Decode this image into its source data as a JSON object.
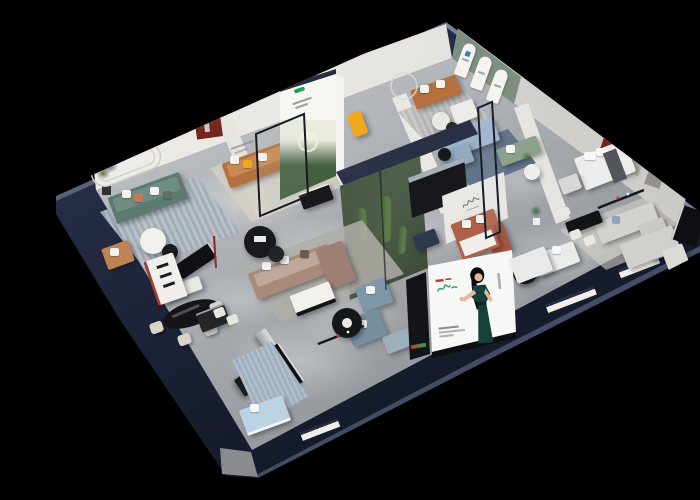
{
  "meta": {
    "title": "Isometric 3D cutaway render of a furniture showroom",
    "style": "dollhouse bird's-eye view, dark navy outer walls, spot-lit interiors, pure black backdrop",
    "legible_text": "none — all signage and logos are too small to read"
  },
  "palette": {
    "bg": "#000000",
    "navyCap": "#272e41",
    "wallWhite": "#efeeea",
    "sage": "#7e8f80",
    "archRed": "#73251f",
    "frameRed": "#b5473f",
    "blueMark": "#3a7fb5",
    "caramel": "#b4713f",
    "teal": "#5d7a71",
    "taupe": "#a8897c",
    "rust": "#b05f49",
    "powder": "#9db3cb",
    "bluegrey": "#7d96a8",
    "sagesofa": "#8aa18c",
    "greySofa": "#d3d3d0",
    "forestA": "#45603f",
    "forestB": "#273d24",
    "plant": "#4d6a42",
    "yellow": "#f2a81d",
    "orange": "#f0941d",
    "brandGreen": "#23a15e",
    "brandRed": "#c03a2e",
    "dress": "#16403a",
    "skin": "#e9b698",
    "rugBeige": "#d6d0c4",
    "rugStripeA": "#b9c2c9",
    "rugStripeB": "#a2acb4",
    "rugGrey": "#b0aea8",
    "rugBlue": "#9fb0bf",
    "rugNavy": "#5b6e86",
    "redAccent": "#a33b2e",
    "blueBed": "#bcd3e4"
  },
  "structure": {
    "outer_walls": "dark navy blue slab with lit top edges",
    "floor": "polished grey concrete with ceiling spot pools",
    "interior_walls": "warm white and light grey partitions, glass dividers"
  },
  "rooms": [
    {
      "name": "living-room-arch-niche",
      "features": [
        "dark red arched wall niche with sculpture",
        "tiny wall caption"
      ],
      "furniture": [
        "caramel leather sofa with yellow and white pillows",
        "black coffee table",
        "beige rug",
        "yellow accent chair"
      ]
    },
    {
      "name": "lounge-teal-sofa",
      "features": [
        "rounded molding lines on wall"
      ],
      "furniture": [
        "teal three-seat sofa with white and terracotta pillows",
        "potted plants",
        "round white coffee table",
        "striped blue-grey rug",
        "tan lounge chair",
        "media console with TV"
      ]
    },
    {
      "name": "gallery-forest-banner",
      "signage": "tall lightbox banner with forest photo, white header and small green logo"
    },
    {
      "name": "living-room-tan-sofa",
      "furniture": [
        "tan leather sofa",
        "white armchair",
        "round side tables",
        "striped grey rug",
        "arc floor lamp"
      ]
    },
    {
      "name": "arched-display-wall",
      "features": [
        "sage green wall",
        "three white arched panels with small blue marks"
      ]
    },
    {
      "name": "living-room-blue-sofa",
      "features": [
        "glass partition"
      ],
      "furniture": [
        "powder blue sectional sofa",
        "navy rug",
        "black side table"
      ]
    },
    {
      "name": "green-sofa-nook",
      "furniture": [
        "sage green sofa",
        "round side table",
        "potted plant"
      ]
    },
    {
      "name": "bedroom-display",
      "features": [
        "six red-framed prints",
        "dark red arched niche",
        "recessed wall panels",
        "vanity mirrors"
      ],
      "furniture": [
        "white bed with dark throw",
        "grey armchair",
        "desk"
      ]
    },
    {
      "name": "sofa-room-grey",
      "furniture": [
        "light grey sectional sofa",
        "black dining table with white chairs",
        "wall shelf with red accents",
        "white daybed",
        "black round table",
        "grey chaise sofa",
        "wall TV"
      ]
    },
    {
      "name": "atrium-planter",
      "features": [
        "glass-walled planter with cacti and white flowers",
        "navy beam",
        "black kitchen unit with steel trim"
      ]
    },
    {
      "name": "signature-display-wall",
      "signage": "white wall with cursive brand signature",
      "furniture": [
        "terracotta sofa group with white cushions",
        "daybed with rust frame"
      ]
    },
    {
      "name": "main-lounge",
      "furniture": [
        "taupe L-shaped sectional sofa",
        "white coffee table on black base",
        "black round display tables",
        "grey rug"
      ]
    },
    {
      "name": "dining-area",
      "furniture": [
        "black oval dining table",
        "cream dining chairs",
        "white shelf with red frame"
      ]
    },
    {
      "name": "bench-gallery",
      "furniture": [
        "long black bench",
        "silver bench",
        "black cabinet",
        "patterned blue rug",
        "light blue bed",
        "blue-grey armchairs",
        "round black coffee table",
        "blue ottoman",
        "white stools"
      ]
    },
    {
      "name": "media-wall",
      "signage": {
        "description": "large white advertising screen on the cut-open edge",
        "subject": "hostess in a dark green evening gown gesturing",
        "logo": "green script wordmark with small red mark",
        "details": [
          "vertical caption strip",
          "small footer text lines"
        ]
      }
    }
  ]
}
